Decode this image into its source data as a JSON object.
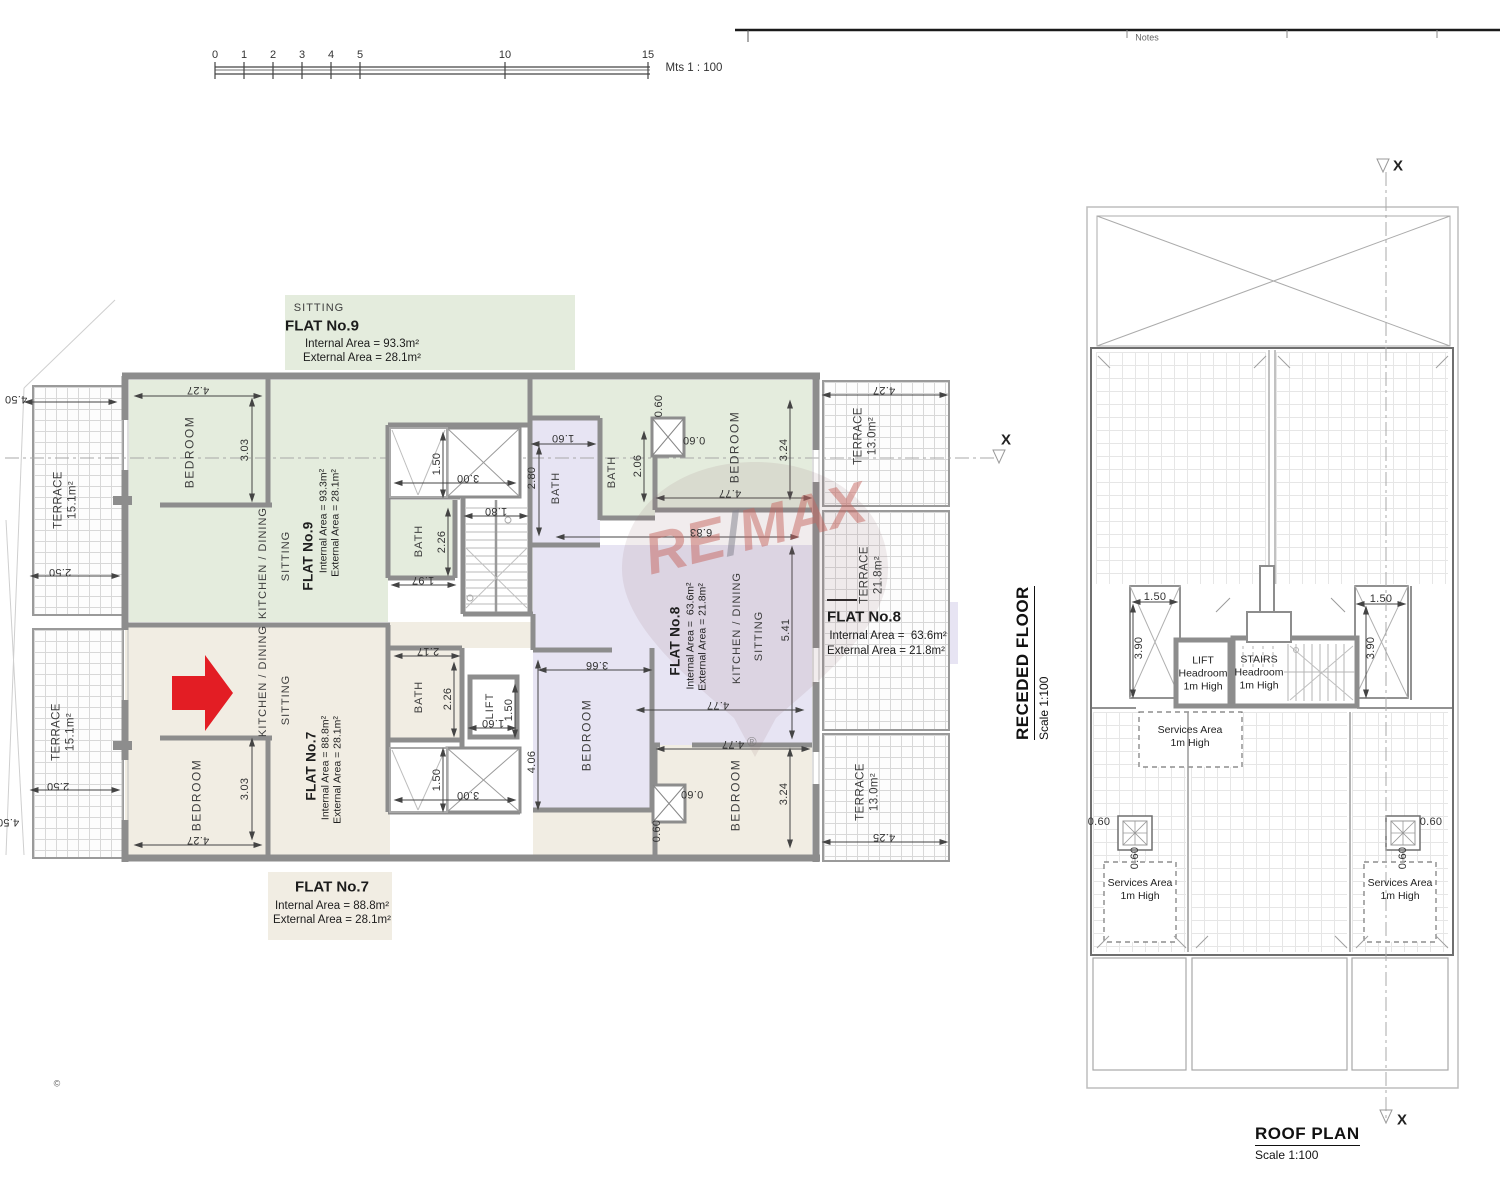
{
  "sheet": {
    "notes": "Notes",
    "copyright": "©"
  },
  "scale_bar": {
    "ticks": [
      "0",
      "1",
      "2",
      "3",
      "4",
      "5",
      "10",
      "15"
    ],
    "unit": "Mts 1 : 100"
  },
  "watermark": {
    "re": "RE",
    "slash": "/",
    "max": "MAX",
    "registered": "®"
  },
  "receded": {
    "title": "RECEDED FLOOR",
    "scale": "Scale 1:100",
    "marker": "X",
    "rooms": {
      "bedroom": "BEDROOM",
      "bath": "BATH",
      "lift": "LIFT",
      "sitting": "SITTING",
      "kitchen": "KITCHEN / DINING",
      "terr151": "TERRACE\n15.1m²",
      "terr130": "TERRACE\n13.0m²",
      "terr218": "TERRACE\n21.8m²"
    },
    "flat9": {
      "name": "FLAT No.9",
      "internal": "Internal Area = 93.3m²",
      "external": "External Area = 28.1m²"
    },
    "flat8": {
      "name": "FLAT No.8",
      "internal": "Internal Area =  63.6m²",
      "external": "External Area = 21.8m²"
    },
    "flat7": {
      "name": "FLAT No.7",
      "internal": "Internal Area = 88.8m²",
      "external": "External Area = 28.1m²"
    },
    "dims": {
      "d060": "0.60",
      "d150": "1.50",
      "d160": "1.60",
      "d180": "1.80",
      "d197": "1.97",
      "d206": "2.06",
      "d217": "2.17",
      "d226": "2.26",
      "d250": "2.50",
      "d280": "2.80",
      "d300": "3.00",
      "d303": "3.03",
      "d324": "3.24",
      "d366": "3.66",
      "d406": "4.06",
      "d425": "4.25",
      "d427": "4.27",
      "d450": "4.50",
      "d477": "4.77",
      "d541": "5.41",
      "d683": "6.83"
    }
  },
  "roof": {
    "title": "ROOF PLAN",
    "scale": "Scale 1:100",
    "marker": "X",
    "lift": "LIFT\nHeadroom\n1m High",
    "stairs": "STAIRS\nHeadroom\n1m High",
    "services": "Services Area\n1m High",
    "dims": {
      "d060": "0.60",
      "d150": "1.50",
      "d390": "3.90"
    }
  }
}
